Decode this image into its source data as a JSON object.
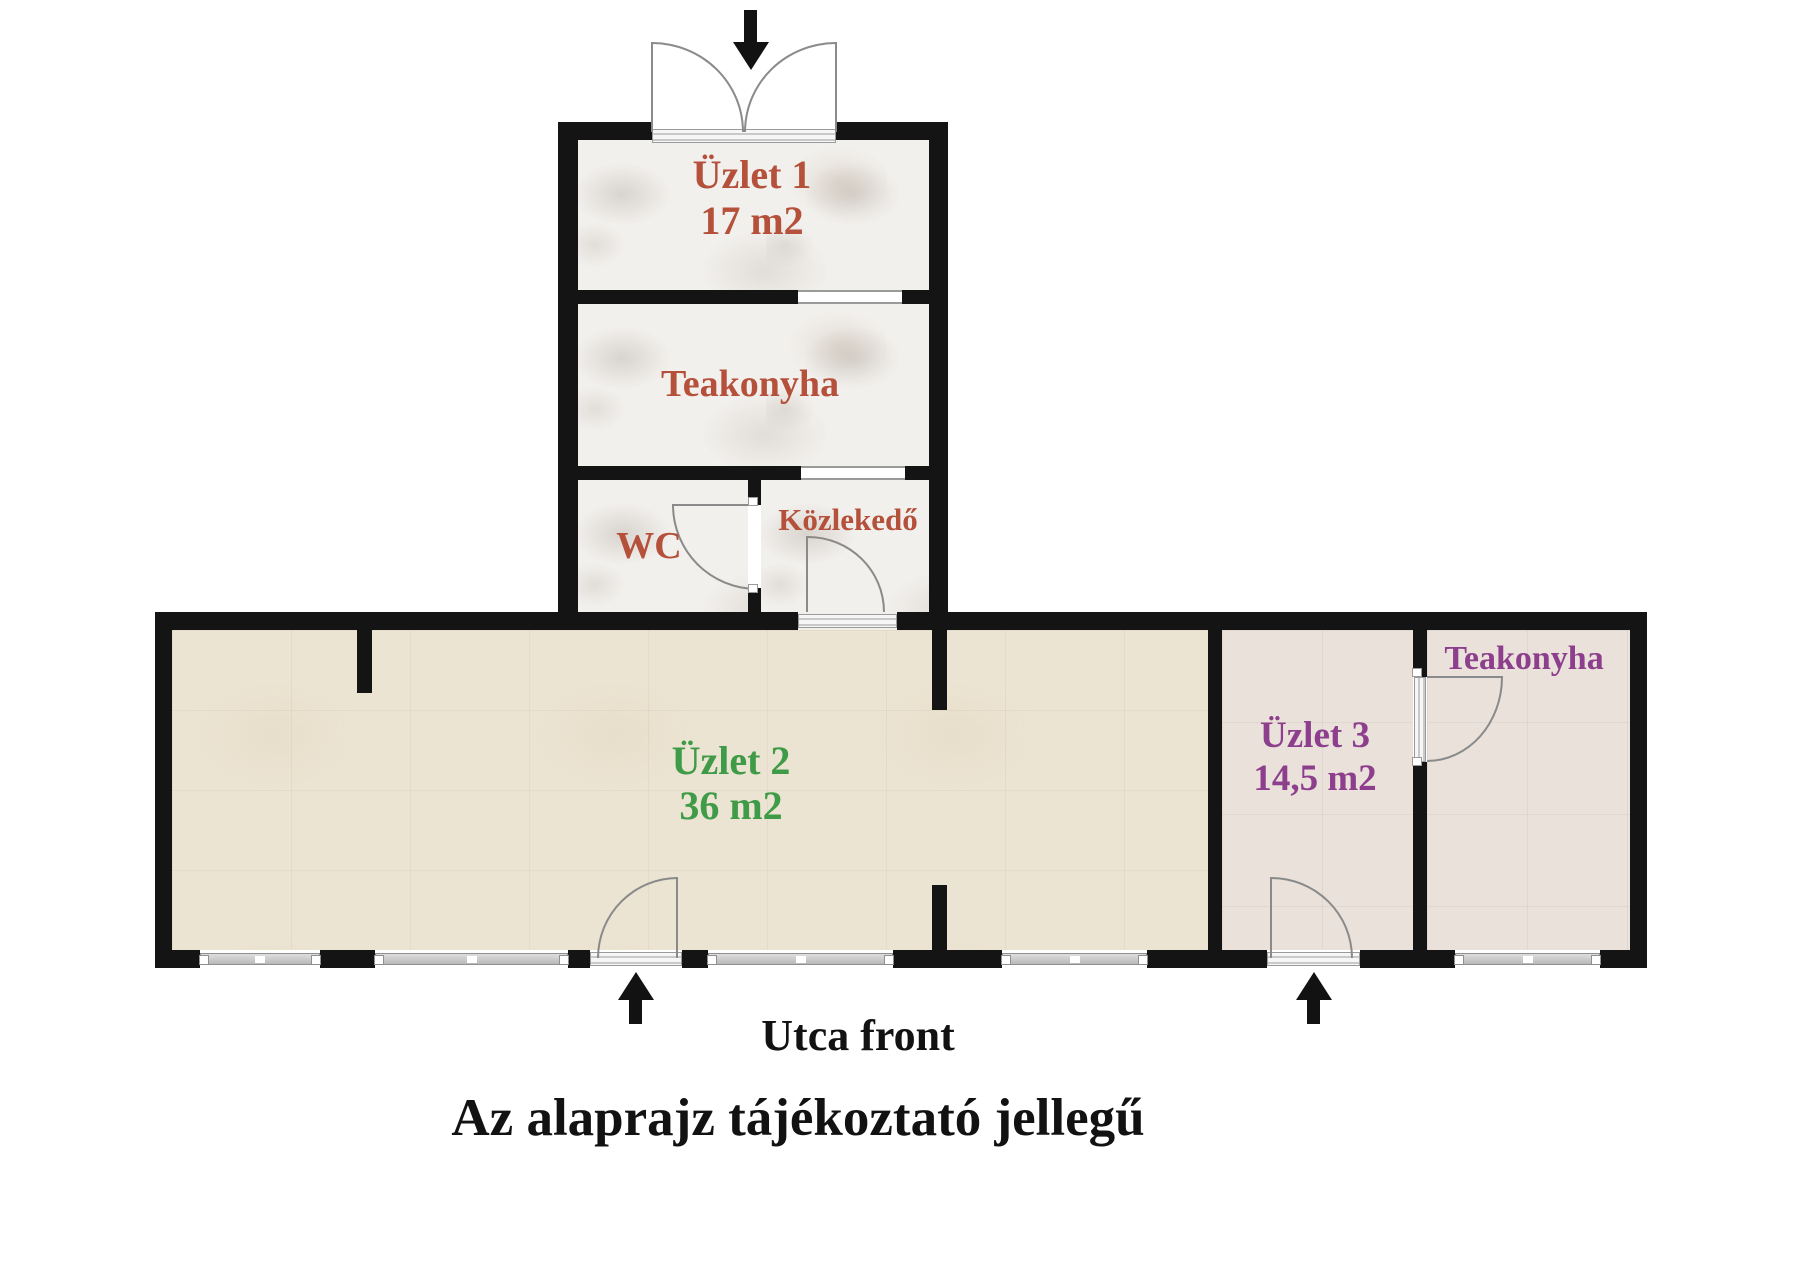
{
  "document": {
    "type": "floor-plan"
  },
  "rooms": {
    "uzlet1": {
      "name": "Üzlet 1",
      "area": "17 m2"
    },
    "teakonyha_top": {
      "name": "Teakonyha"
    },
    "wc": {
      "name": "WC"
    },
    "kozlekedo": {
      "name": "Közlekedő"
    },
    "uzlet2": {
      "name": "Üzlet 2",
      "area": "36 m2"
    },
    "uzlet3": {
      "name": "Üzlet 3",
      "area": "14,5 m2"
    },
    "teakonyha_uzlet3": {
      "name": "Teakonyha"
    }
  },
  "labels": {
    "street_front": "Utca front",
    "disclaimer": "Az alaprajz tájékoztató jellegű"
  },
  "colors": {
    "wall": "#141414",
    "label_red": "#b5503a",
    "label_green": "#3f9b47",
    "label_purple": "#8d3f8d",
    "text_black": "#121212",
    "floor_marble": "#f2f0ed",
    "floor_cream": "#ece4d2",
    "floor_rose": "#e9e1da",
    "window_gray": "#c2c2c2",
    "arc_gray": "#8a8a8a"
  }
}
